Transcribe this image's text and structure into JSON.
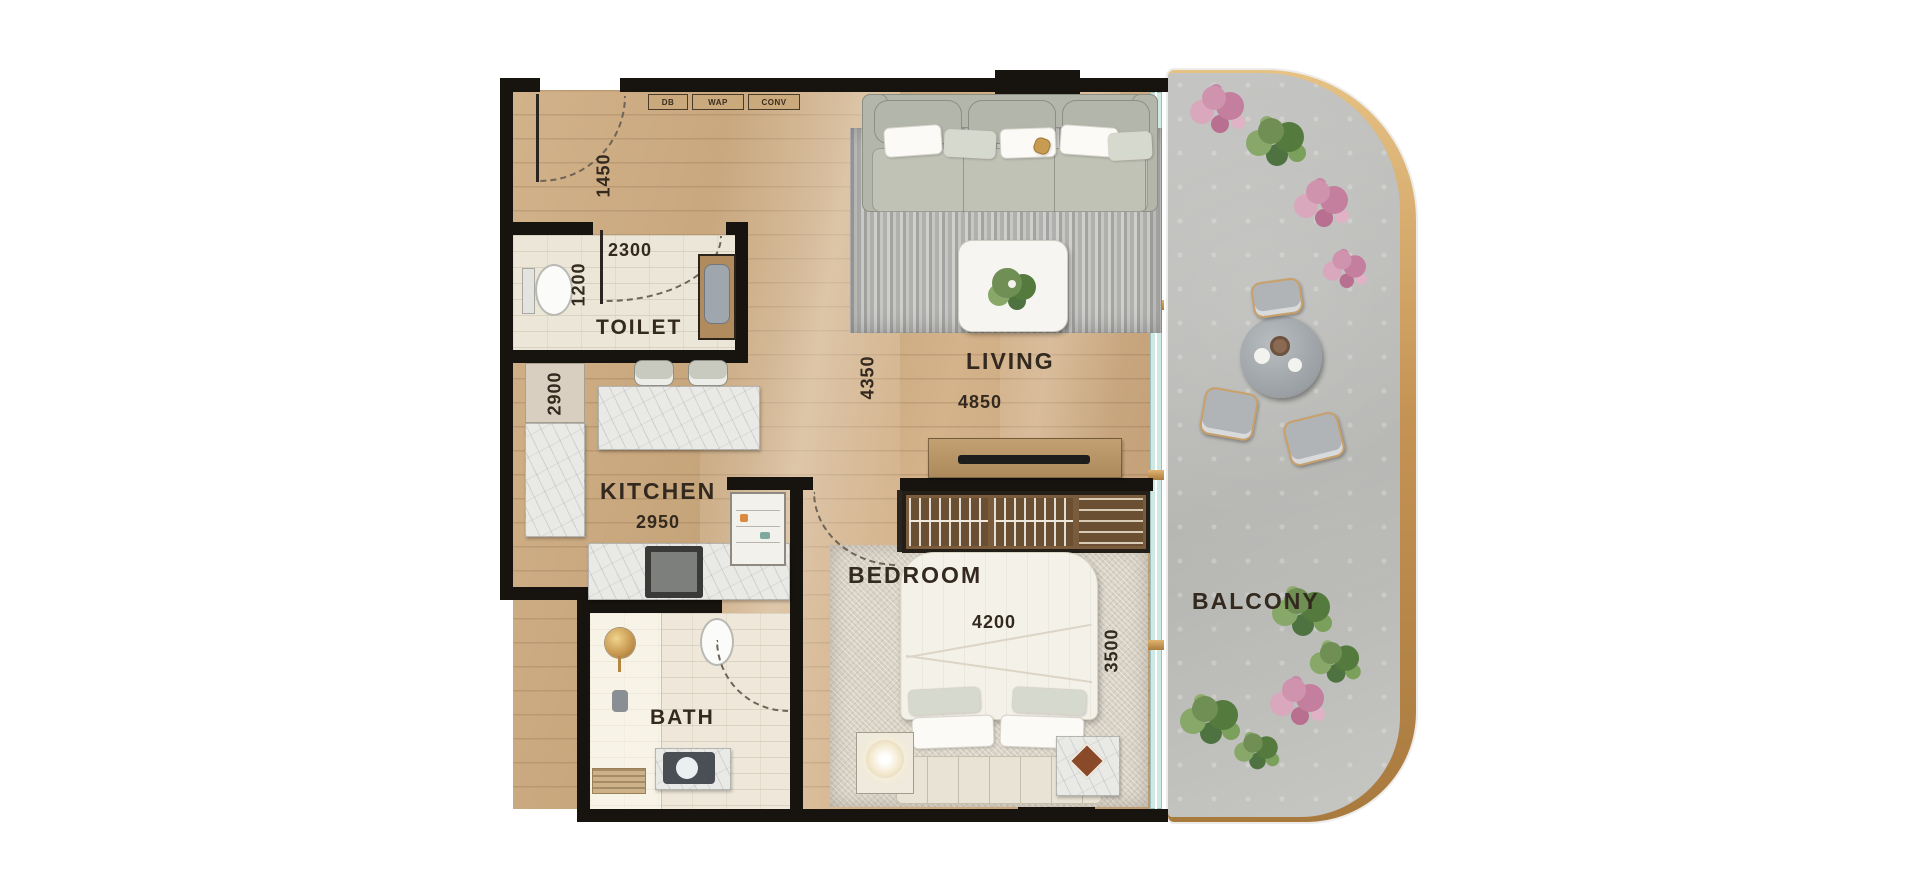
{
  "floorplan": {
    "entry": {
      "door_dim": "1450",
      "panels": [
        "DB",
        "WAP",
        "CONV"
      ]
    },
    "toilet": {
      "label": "TOILET",
      "width_mm": "2300",
      "depth_mm": "1200"
    },
    "kitchen": {
      "label": "KITCHEN",
      "width_mm": "2950",
      "depth_mm": "2900"
    },
    "bath": {
      "label": "BATH"
    },
    "living": {
      "label": "LIVING",
      "width_mm": "4850",
      "depth_mm": "4350"
    },
    "bedroom": {
      "label": "BEDROOM",
      "width_mm": "4200",
      "depth_mm": "3500"
    },
    "balcony": {
      "label": "BALCONY"
    },
    "colors": {
      "wall": "#17130f",
      "wood_floor": "#c9a87f",
      "label_text": "#33291f",
      "balcony_concrete": "#bdbdba",
      "gold_trim": "#c08c4e",
      "glass": "#cfe9e4"
    }
  }
}
